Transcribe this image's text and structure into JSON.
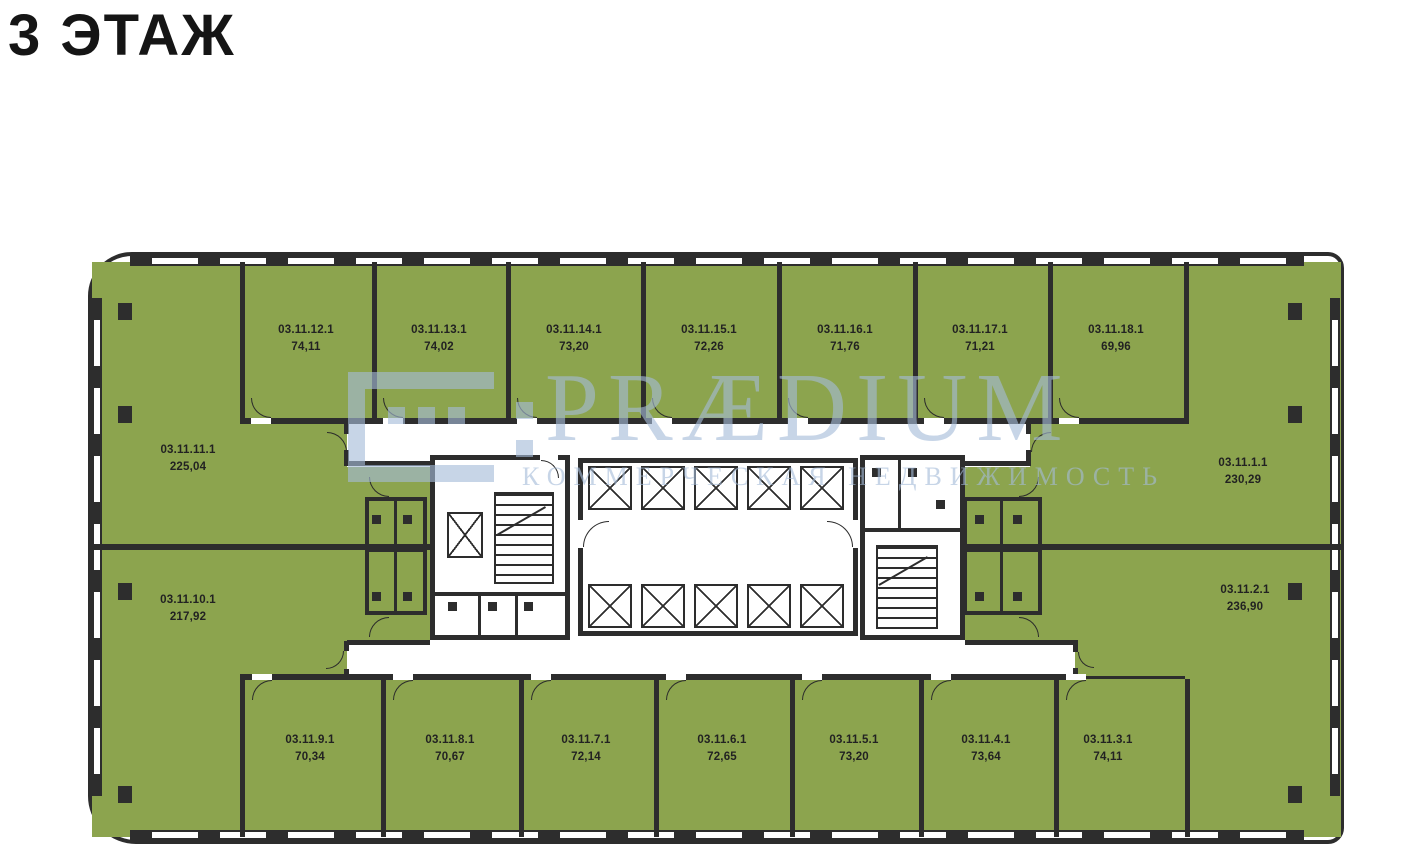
{
  "page": {
    "title": "3 ЭТАЖ"
  },
  "watermark": {
    "brand": "PRÆDIUM",
    "subtitle": "КОММЕРЧЕСКАЯ НЕДВИЖИМОСТЬ"
  },
  "floor_plan": {
    "colors": {
      "room_fill": "#8CA44E",
      "wall": "#2D2D2D",
      "watermark_blue": "#A4BCD8"
    },
    "rooms": [
      {
        "id": "03.11.1.1",
        "area": "230,29"
      },
      {
        "id": "03.11.2.1",
        "area": "236,90"
      },
      {
        "id": "03.11.3.1",
        "area": "74,11"
      },
      {
        "id": "03.11.4.1",
        "area": "73,64"
      },
      {
        "id": "03.11.5.1",
        "area": "73,20"
      },
      {
        "id": "03.11.6.1",
        "area": "72,65"
      },
      {
        "id": "03.11.7.1",
        "area": "72,14"
      },
      {
        "id": "03.11.8.1",
        "area": "70,67"
      },
      {
        "id": "03.11.9.1",
        "area": "70,34"
      },
      {
        "id": "03.11.10.1",
        "area": "217,92"
      },
      {
        "id": "03.11.11.1",
        "area": "225,04"
      },
      {
        "id": "03.11.12.1",
        "area": "74,11"
      },
      {
        "id": "03.11.13.1",
        "area": "74,02"
      },
      {
        "id": "03.11.14.1",
        "area": "73,20"
      },
      {
        "id": "03.11.15.1",
        "area": "72,26"
      },
      {
        "id": "03.11.16.1",
        "area": "71,76"
      },
      {
        "id": "03.11.17.1",
        "area": "71,21"
      },
      {
        "id": "03.11.18.1",
        "area": "69,96"
      }
    ]
  }
}
